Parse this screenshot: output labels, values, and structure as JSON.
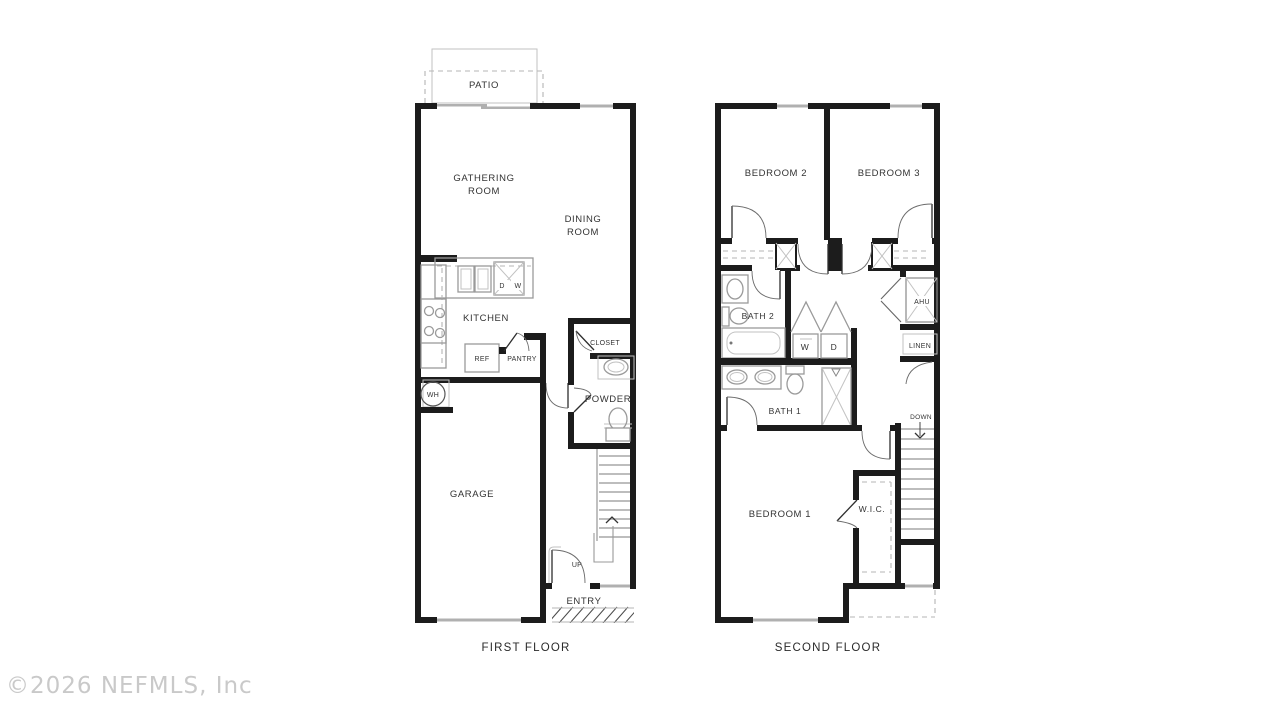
{
  "watermark": "©2026 NEFMLS, Inc",
  "first_floor": {
    "title": "FIRST FLOOR",
    "rooms": {
      "patio": "PATIO",
      "gathering_line1": "GATHERING",
      "gathering_line2": "ROOM",
      "dining_line1": "DINING",
      "dining_line2": "ROOM",
      "kitchen": "KITCHEN",
      "garage": "GARAGE",
      "powder": "POWDER",
      "closet": "CLOSET",
      "entry": "ENTRY"
    },
    "fixtures": {
      "ref": "REF",
      "pantry": "PANTRY",
      "water_heater": "WH",
      "dishwasher_left": "D",
      "dishwasher_right": "W",
      "stairs_direction": "UP"
    }
  },
  "second_floor": {
    "title": "SECOND FLOOR",
    "rooms": {
      "bedroom1": "BEDROOM 1",
      "bedroom2": "BEDROOM 2",
      "bedroom3": "BEDROOM 3",
      "bath1": "BATH 1",
      "bath2": "BATH 2",
      "walk_in_closet": "W.I.C.",
      "ahu": "AHU",
      "linen": "LINEN"
    },
    "fixtures": {
      "washer": "W",
      "dryer": "D",
      "stairs_direction": "DOWN"
    }
  },
  "colors": {
    "wall": "#1c1c1c",
    "window": "#b0b0b0",
    "fixture": "#9a9a9a",
    "text": "#333333",
    "watermark": "#c9c9c9",
    "background": "#ffffff"
  }
}
